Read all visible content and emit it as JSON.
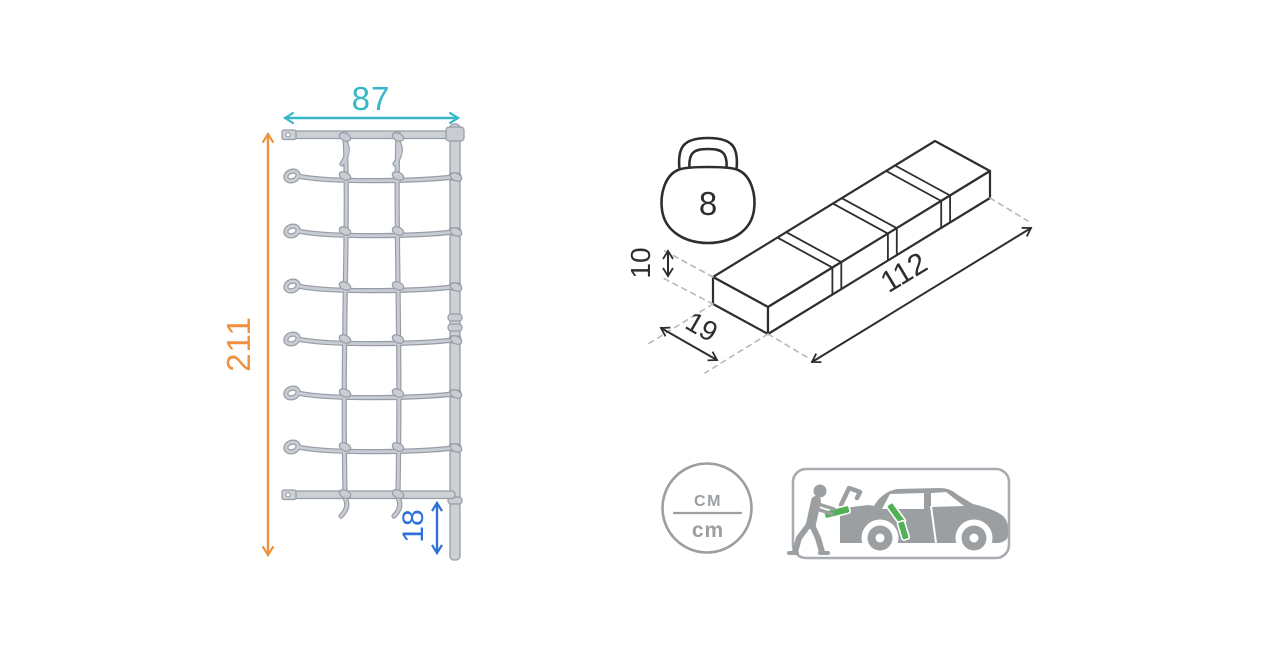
{
  "colors": {
    "teal": "#35b7c9",
    "orange": "#f0913f",
    "blue": "#2e72d8",
    "dark": "#2e2e2e",
    "gray": "#9b9fa2",
    "panelgray": "#a8acb0",
    "green": "#53b155",
    "rope": "#c9cdd3",
    "ropeline": "#979da6",
    "dash": "#b8b8b8",
    "barfill": "#cdd1d6"
  },
  "net": {
    "width": "87",
    "height": "211",
    "pole_offset": "18"
  },
  "package": {
    "weight": "8",
    "length": "112",
    "depth": "19",
    "height": "10"
  },
  "units": {
    "top": "CM",
    "bottom": "cm"
  }
}
